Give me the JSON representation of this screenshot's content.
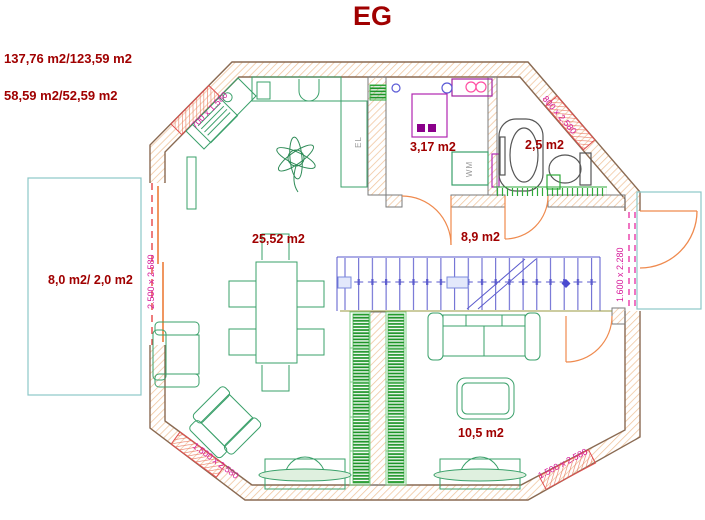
{
  "header": {
    "title": "EG",
    "area_line1": "137,76 m2/123,59 m2",
    "area_line2": "58,59 m2/52,59 m2"
  },
  "rooms": {
    "kitchen_living": {
      "label": "25,52 m2"
    },
    "bathroom": {
      "label": "3,17 m2"
    },
    "wc": {
      "label": "2,5 m2"
    },
    "hallway": {
      "label": "8,9 m2"
    },
    "living": {
      "label": "10,5 m2"
    },
    "terrace_left": {
      "label": "8,0 m2/ 2,0 m2"
    }
  },
  "openings": {
    "window_top_left": "700 x 1.580",
    "window_top_right": "800 x 2.580",
    "slide_door_left": "2.500 x 2.580",
    "door_right": "1.600 x 2.280",
    "window_bottom_left": "1.500 x 2.580",
    "window_bottom_right": "1.500 x 2.580"
  },
  "appliances": {
    "washing_machine": "WM",
    "kitchen_unit": "EL"
  },
  "colors": {
    "wall_hatch": "#f0c49c",
    "wall_outline": "#8a6a52",
    "window_red": "#e05050",
    "label_red": "#a00000",
    "dimension_magenta": "#d6199a",
    "furniture_green": "#3aa06a",
    "books_green": "#1d9428",
    "stairs_blue": "#5a5acd",
    "door_orange": "#ef8a4e",
    "terrace_teal": "#8cc7c7",
    "fixture_purple": "#b026b0",
    "fixture_pink": "#ff4fa3",
    "fixture_blue": "#5b5bd6",
    "sanitary_gray": "#555555",
    "dashed_red": "#e64545"
  }
}
